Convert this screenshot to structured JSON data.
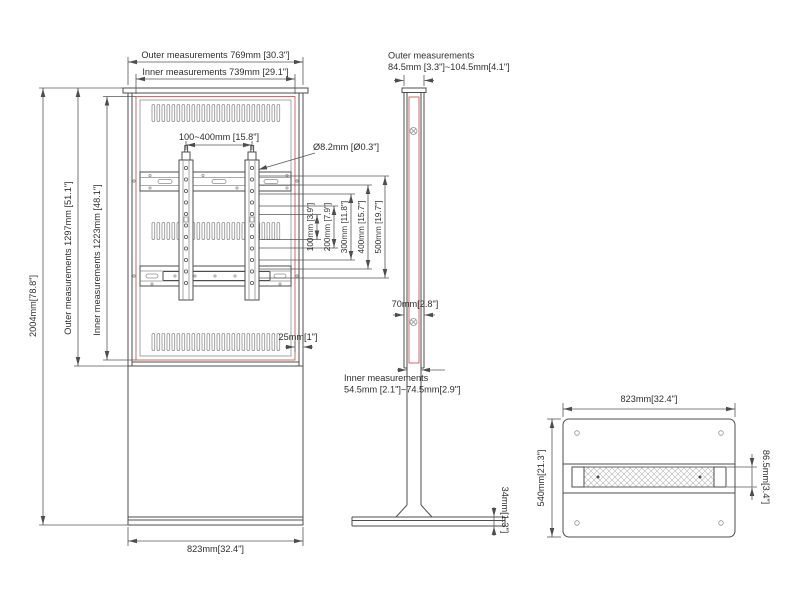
{
  "drawing": {
    "front_view": {
      "dim_outer_width": "Outer measurements 769mm [30.3\"]",
      "dim_inner_width": "Inner measurements 739mm [29.1\"]",
      "dim_total_height": "2004mm[78.8\"]",
      "dim_outer_height": "Outer measurements  1297mm [51.1\"]",
      "dim_inner_height": "Inner measurements  1223mm [48.1\"]",
      "dim_vesa_width": "100~400mm [15.8\"]",
      "dim_hole_diameter": "Ø8.2mm [Ø0.3\"]",
      "vesa_heights": [
        "100mm [3.9\"]",
        "200mm [7.9\"]",
        "300mm [11.8\"]",
        "400mm [15.7\"]",
        "500mm [19.7\"]"
      ],
      "dim_bezel": "25mm[1\"]",
      "dim_base_width": "823mm[32.4\"]"
    },
    "side_view": {
      "dim_outer_label": "Outer measurements",
      "dim_outer_value": "84.5mm [3.3\"]~104.5mm[4.1\"]",
      "dim_column_width": "70mm[2.8\"]",
      "dim_inner_label": "Inner measurements",
      "dim_inner_value": "54.5mm [2.1\"]~74.5mm[2.9\"]",
      "dim_base_height": "34mm[1.3\"]"
    },
    "top_view": {
      "dim_width": "823mm[32.4\"]",
      "dim_depth": "540mm[21.3\"]",
      "dim_column_depth": "86.5mm[3.4\"]"
    },
    "colors": {
      "line": "#4d4d4d",
      "accent_red": "#c0605f"
    }
  }
}
